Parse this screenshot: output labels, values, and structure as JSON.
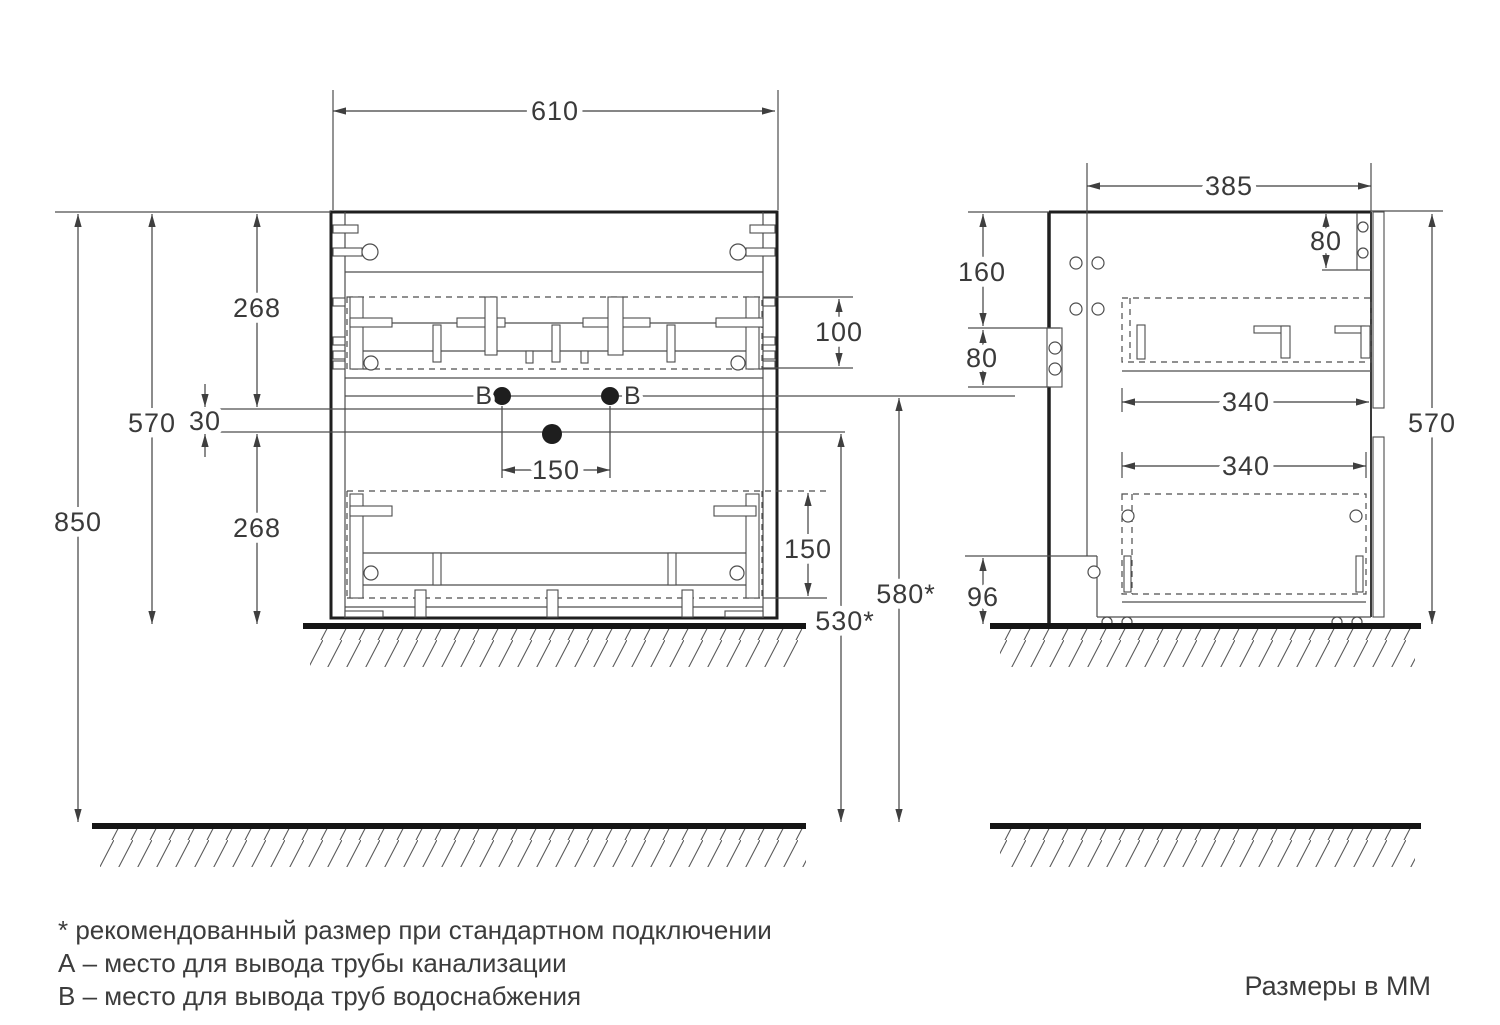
{
  "front_view": {
    "dim_width_top": "610",
    "dim_height_to_floor": "850",
    "dim_height_cabinet": "570",
    "dim_drawer_top": "268",
    "dim_gap": "30",
    "dim_drawer_bottom": "268",
    "dim_top_drawer_inner": "100",
    "dim_supply_spacing": "150",
    "dim_bottom_drawer_inner": "150",
    "dim_drain_height": "530*",
    "dim_supply_height": "580*",
    "label_supply_left": "В",
    "label_supply_right": "В"
  },
  "side_view": {
    "dim_depth": "385",
    "dim_hanger_drop": "80",
    "dim_back_top": "160",
    "dim_bracket": "80",
    "dim_drawer_depth_top": "340",
    "dim_drawer_depth_bottom": "340",
    "dim_plinth": "96",
    "dim_height": "570"
  },
  "notes": {
    "asterisk": "* рекомендованный размер при стандартном подключении",
    "a": "А – место для вывода трубы канализации",
    "b": "В – место для вывода труб водоснабжения",
    "units": "Размеры в ММ"
  },
  "colors": {
    "ink": "#3a3a3a",
    "line": "#4d4d4d",
    "border": "#1f1f1f",
    "background": "#ffffff"
  }
}
